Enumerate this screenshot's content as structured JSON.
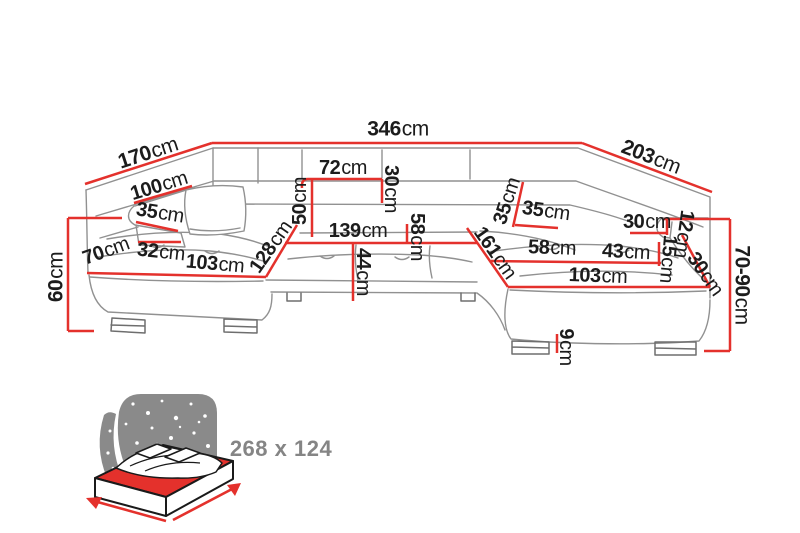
{
  "figure": {
    "type": "corner-sofa-dimension-diagram",
    "unit_system": "cm"
  },
  "dims": {
    "d170": {
      "value": "170",
      "unit": "cm"
    },
    "d346": {
      "value": "346",
      "unit": "cm"
    },
    "d203": {
      "value": "203",
      "unit": "cm"
    },
    "d60": {
      "value": "60",
      "unit": "cm"
    },
    "d100": {
      "value": "100",
      "unit": "cm"
    },
    "d35_left": {
      "value": "35",
      "unit": "cm"
    },
    "d70": {
      "value": "70",
      "unit": "cm"
    },
    "d32": {
      "value": "32",
      "unit": "cm"
    },
    "d103_left": {
      "value": "103",
      "unit": "cm"
    },
    "d128": {
      "value": "128",
      "unit": "cm"
    },
    "d50": {
      "value": "50",
      "unit": "cm"
    },
    "d72": {
      "value": "72",
      "unit": "cm"
    },
    "d30_top": {
      "value": "30",
      "unit": "cm"
    },
    "d139": {
      "value": "139",
      "unit": "cm"
    },
    "d58_mid": {
      "value": "58",
      "unit": "cm"
    },
    "d44": {
      "value": "44",
      "unit": "cm"
    },
    "d35_center_v": {
      "value": "35",
      "unit": "cm"
    },
    "d35_center_h": {
      "value": "35",
      "unit": "cm"
    },
    "d161": {
      "value": "161",
      "unit": "cm"
    },
    "d58_right": {
      "value": "58",
      "unit": "cm"
    },
    "d43": {
      "value": "43",
      "unit": "cm"
    },
    "d103_right": {
      "value": "103",
      "unit": "cm"
    },
    "d30_right": {
      "value": "30",
      "unit": "cm"
    },
    "d12": {
      "value": "12",
      "unit": "cm"
    },
    "d15": {
      "value": "15",
      "unit": "cm"
    },
    "d30_corner": {
      "value": "30",
      "unit": "cm"
    },
    "d70_90": {
      "value": "70-90",
      "unit": "cm"
    },
    "d9": {
      "value": "9",
      "unit": "cm"
    }
  },
  "bed": {
    "size_label": "268 x 124"
  },
  "colors": {
    "dimension_red": "#e4312c",
    "outline_gray": "#919191",
    "text_black": "#1c1c1c",
    "icon_gray": "#8a8a8a",
    "bed_text_gray": "#858585"
  }
}
